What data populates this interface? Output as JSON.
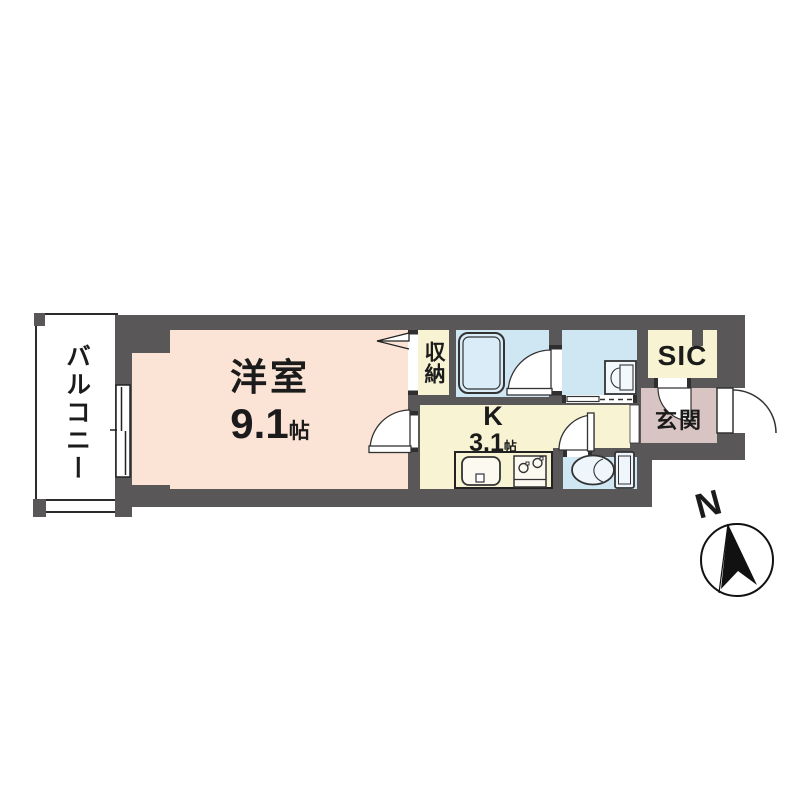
{
  "plan": {
    "type": "japanese-apartment-floor-plan",
    "labels": {
      "balcony": "バルコニー",
      "west_room": "洋室",
      "west_room_size": "9.1",
      "west_room_unit": "帖",
      "closet": "収納",
      "kitchen": "K",
      "kitchen_size": "3.1",
      "kitchen_unit": "帖",
      "sic": "SIC",
      "entrance": "玄関",
      "north": "N"
    },
    "rooms": [
      {
        "name": "バルコニー",
        "kind": "balcony"
      },
      {
        "name": "洋室",
        "size_jo": "9.1帖",
        "kind": "western-room"
      },
      {
        "name": "収納",
        "kind": "closet"
      },
      {
        "name": "K",
        "size_jo": "3.1帖",
        "kind": "kitchen"
      },
      {
        "name": "SIC",
        "kind": "shoes-in-closet"
      },
      {
        "name": "玄関",
        "kind": "entrance-hall"
      },
      {
        "kind": "bathroom-with-tub"
      },
      {
        "kind": "washroom-with-vanity"
      },
      {
        "kind": "toilet-room"
      }
    ],
    "fixtures": [
      "bathtub",
      "vanity-sink",
      "toilet",
      "kitchen-sink",
      "gas-stove",
      "sliding-window",
      "folding-closet-door",
      "hinged-doors",
      "sliding-door",
      "entrance-door",
      "compass-north-arrow"
    ],
    "colors": {
      "wall": "#595757",
      "west_room_fill": "#fbe3d5",
      "kitchen_closet_sic_fill": "#f8f3d3",
      "wet_area_fill": "#cfe7f3",
      "entrance_fill": "#d8c5c3",
      "balcony_fill": "#ffffff",
      "line": "#333333"
    }
  }
}
